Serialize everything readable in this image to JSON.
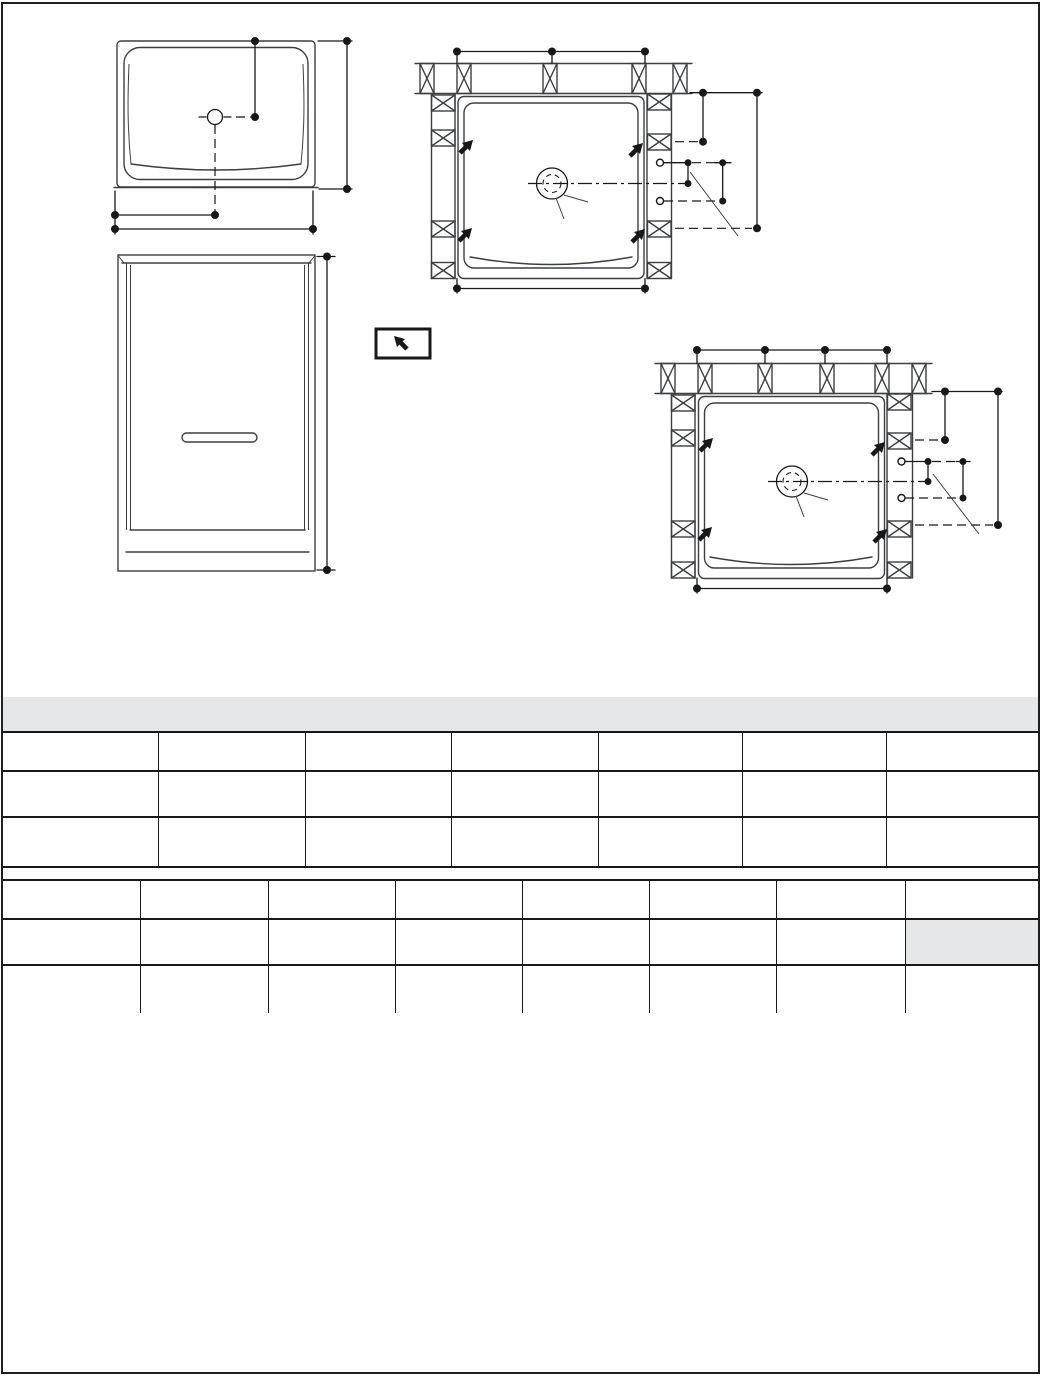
{
  "page": {
    "colors": {
      "bg": "#ffffff",
      "border": "#1f2023",
      "ink": "#16181a",
      "line": "#3c3f42",
      "band_fill": "#e4e6e8",
      "highlight_fill": "#e4e6e8"
    }
  },
  "title_band": {
    "text": ""
  },
  "tables": {
    "upper": {
      "col_widths": [
        156,
        147,
        146,
        147,
        144,
        144,
        151
      ],
      "row_heights": [
        39,
        46,
        50
      ],
      "rows": [
        [
          "",
          "",
          "",
          "",
          "",
          "",
          ""
        ],
        [
          "",
          "",
          "",
          "",
          "",
          "",
          ""
        ],
        [
          "",
          "",
          "",
          "",
          "",
          "",
          ""
        ]
      ]
    },
    "lower": {
      "col_widths": [
        138,
        128,
        127,
        127,
        127,
        127,
        129,
        132
      ],
      "row_heights": [
        39,
        46,
        49
      ],
      "rows": [
        [
          "",
          "",
          "",
          "",
          "",
          "",
          "",
          ""
        ],
        [
          "",
          "",
          "",
          "",
          "",
          "",
          "",
          ""
        ],
        [
          "",
          "",
          "",
          "",
          "",
          "",
          "",
          ""
        ]
      ],
      "highlight_cell": {
        "row": 1,
        "col": 7
      }
    }
  },
  "notes_area": {
    "text": ""
  }
}
